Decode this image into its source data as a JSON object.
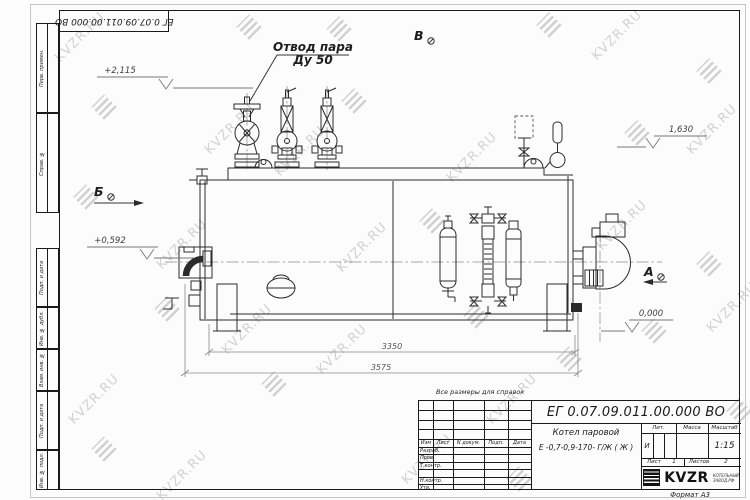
{
  "watermark": {
    "text": "KVZR.RU"
  },
  "corner_stamp": {
    "doc_number": "ЕГ 0.07.09.011.00.000  ВО"
  },
  "margin_labels": {
    "perv_primen": "Перв. примен.",
    "sprav_no": "Справ. №",
    "podp_data_1": "Подп. и дата",
    "inv_dubl": "Инв. № дубл.",
    "vzam_inv": "Взам. инв. №",
    "podp_data_2": "Подп. и дата",
    "inv_podl": "Инв. № подл."
  },
  "drawing": {
    "callout_line1": "Отвод пара",
    "callout_line2": "Ду 50",
    "view_a": "А",
    "view_b": "Б",
    "view_v": "В",
    "elev_top_left": "+2,115",
    "elev_right": "1,630",
    "elev_mid_left": "+0,592",
    "elev_zero": "0,000",
    "dim_inner": "3350",
    "dim_outer": "3575"
  },
  "note": "Все размеры для справок",
  "title_block": {
    "doc_number": "ЕГ 0.07.09.011.00.000  ВО",
    "product_name_line1": "Котел паровой",
    "product_name_line2": "Е -0,7-0,9-170- Г/Ж ( Ж )",
    "col_izm": "Изм",
    "col_list": "Лист",
    "col_ndoc": "N докум.",
    "col_podp": "Подп.",
    "col_data": "Дата",
    "row_razrab": "Разраб.",
    "row_prov": "Пров.",
    "row_tkontr": "Т.контр.",
    "row_nkontr": "Н.контр.",
    "row_utv": "Утв.",
    "lit_header": "Лит.",
    "mass_header": "Масса",
    "scale_header": "Масштаб",
    "lit_value": "И",
    "scale_value": "1:15",
    "sheet_label": "Лист",
    "sheet_number": "1",
    "sheets_label": "Листов",
    "sheets_total": "2",
    "logo_text": "KVZR",
    "logo_sub_line1": "КОТЕЛЬНЫЙ",
    "logo_sub_line2": "ЗАВОД.РФ",
    "format_label": "Формат А3"
  }
}
